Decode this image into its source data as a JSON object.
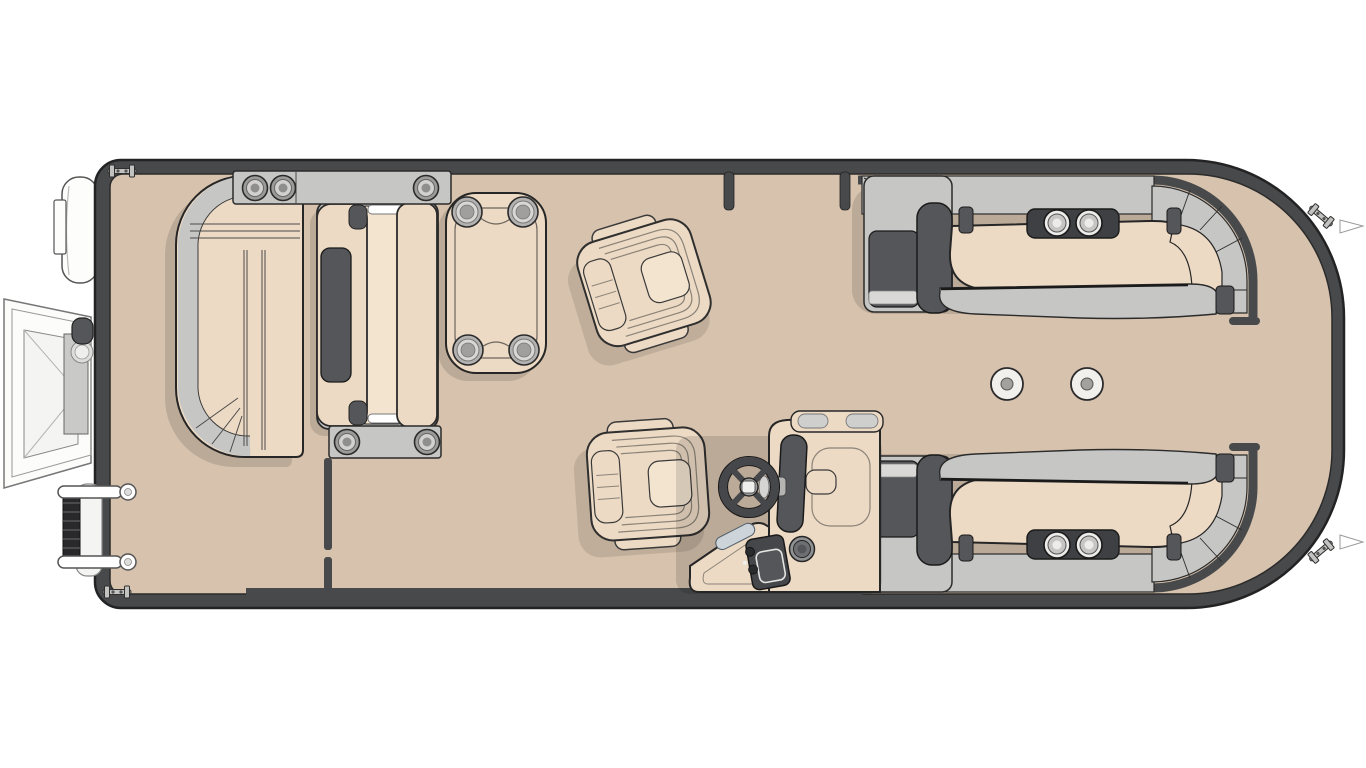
{
  "meta": {
    "title": "Pontoon boat floor plan - top-down view",
    "canvas": {
      "width": 1366,
      "height": 768
    }
  },
  "palette": {
    "background": "#ffffff",
    "hull_rail": "#48494b",
    "outline": "#262626",
    "deck": "#d6c2ad",
    "cushion": "#eddac4",
    "cushion_light": "#f3e4d0",
    "panel_light": "#c6c6c5",
    "panel_mid": "#b2b1b0",
    "hardware_dark": "#55565a",
    "accent_steel": "#cdd5da",
    "shadow": "rgba(0,0,0,0.12)"
  },
  "components": [
    {
      "id": "outboard-motor",
      "label": "Outboard motor (stern, port corner)"
    },
    {
      "id": "swim-platform",
      "label": "Fold-out swim platform (stern)"
    },
    {
      "id": "boarding-ladder",
      "label": "Boarding ladder, 2 rungs (stern)"
    },
    {
      "id": "stern-cleats",
      "label": "Stern mooring cleats",
      "count": 2
    },
    {
      "id": "bow-cleats",
      "label": "Bow mooring cleats (angled)",
      "count": 2
    },
    {
      "id": "fender-clips",
      "label": "Bow fender clips",
      "count": 2
    },
    {
      "id": "aft-lounge",
      "label": "Aft L-lounge seat",
      "cup_holders": 0
    },
    {
      "id": "aft-armrest-top",
      "label": "Aft top armrest console",
      "cup_holders": 3
    },
    {
      "id": "aft-bench",
      "label": "Convertible aft bench with recline panel"
    },
    {
      "id": "aft-armrest-bottom",
      "label": "Aft bottom armrest console",
      "cup_holders": 2
    },
    {
      "id": "dinette-table",
      "label": "Dinette table",
      "cup_holders": 4
    },
    {
      "id": "captain-chair-aft",
      "label": "Swivel captain chair (aft, rotated)"
    },
    {
      "id": "captain-chair-helm",
      "label": "Swivel captain chair (helm)"
    },
    {
      "id": "helm-console",
      "label": "Helm console with steering wheel, windscreen, throttle panel",
      "cup_holders": 1
    },
    {
      "id": "bow-lounge-top",
      "label": "Bow lounge seat (top) with storage armrest",
      "cup_holders": 2
    },
    {
      "id": "bow-lounge-bottom",
      "label": "Bow lounge seat (bottom) with storage armrest",
      "cup_holders": 2
    },
    {
      "id": "pedestal-mounts",
      "label": "Table pedestal floor mounts",
      "count": 2
    },
    {
      "id": "side-gate",
      "label": "Side boarding gate posts (top rail)"
    },
    {
      "id": "bow-gate",
      "label": "Bow boarding gate opening (front fence)"
    },
    {
      "id": "stern-gate-divider",
      "label": "Stern gate divider wall"
    }
  ]
}
